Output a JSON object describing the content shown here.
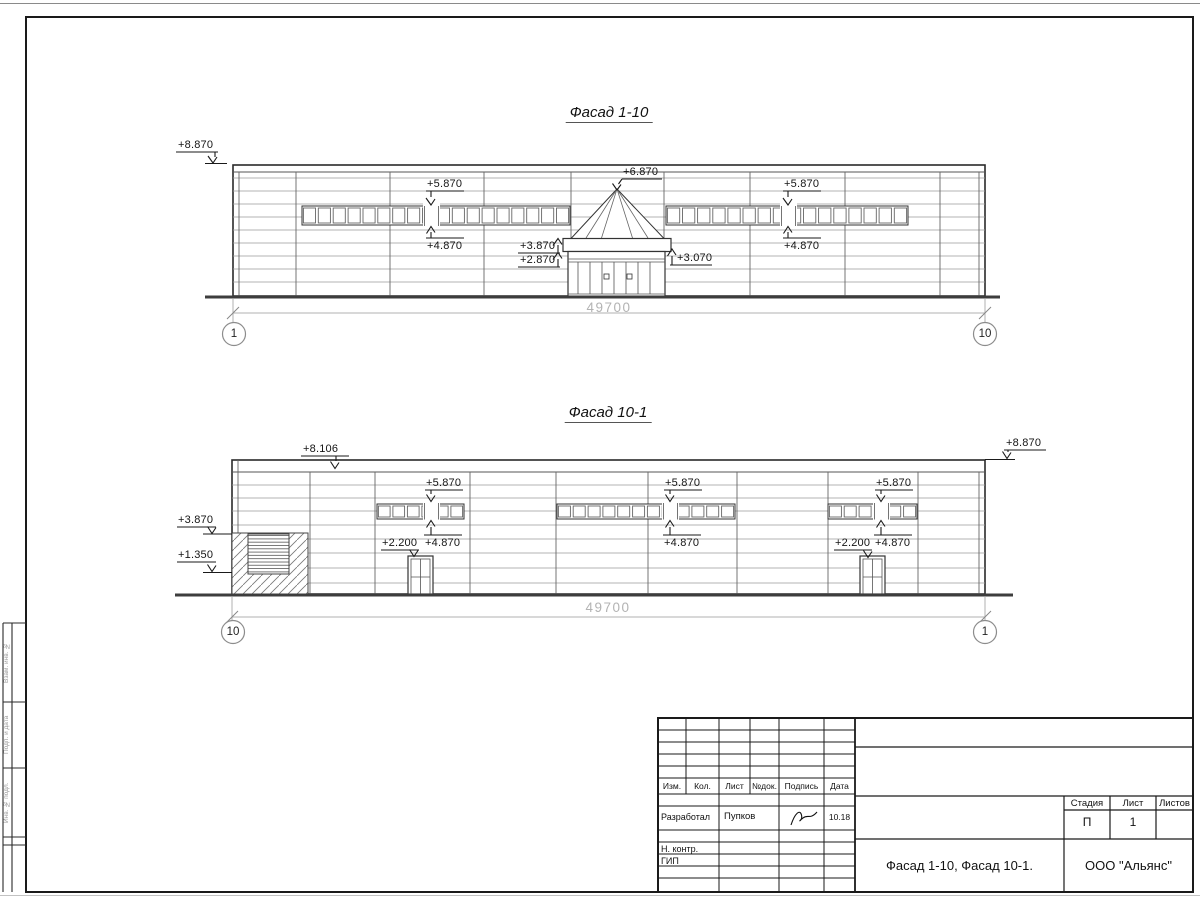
{
  "facade_top": {
    "title": "Фасад 1-10",
    "marks": {
      "m8870": "+8.870",
      "m5870_left": "+5.870",
      "m6870": "+6.870",
      "m5870_right": "+5.870",
      "m4870_left": "+4.870",
      "m3870": "+3.870",
      "m2870": "+2.870",
      "m3070": "+3.070",
      "m4870_right": "+4.870"
    },
    "dimension": "49700",
    "axis_left": "1",
    "axis_right": "10"
  },
  "facade_bottom": {
    "title": "Фасад 10-1",
    "marks": {
      "m8106": "+8.106",
      "m8870": "+8.870",
      "m3870": "+3.870",
      "m1350": "+1.350",
      "m5870_a": "+5.870",
      "m4870_a": "+4.870",
      "m2200_a": "+2.200",
      "m5870_b": "+5.870",
      "m4870_b": "+4.870",
      "m5870_c": "+5.870",
      "m4870_c": "+4.870",
      "m2200_c": "+2.200"
    },
    "dimension": "49700",
    "axis_left": "10",
    "axis_right": "1"
  },
  "title_block": {
    "cols": [
      "Изм.",
      "Кол.",
      "Лист",
      "№док.",
      "Подпись",
      "Дата"
    ],
    "developed_label": "Разработал",
    "developed_name": "Пупков",
    "developed_date": "10.18",
    "ncontr_label": "Н. контр.",
    "gip_label": "ГИП",
    "stage_label": "Стадия",
    "sheet_label": "Лист",
    "sheets_label": "Листов",
    "stage_value": "П",
    "sheet_value": "1",
    "doc_title": "Фасад 1-10, Фасад 10-1.",
    "company": "ООО \"Альянс\""
  },
  "side_stamp": {
    "row1": "Взам. инв. №",
    "row2": "Подп. и дата",
    "row3": "Инв. № подл."
  }
}
